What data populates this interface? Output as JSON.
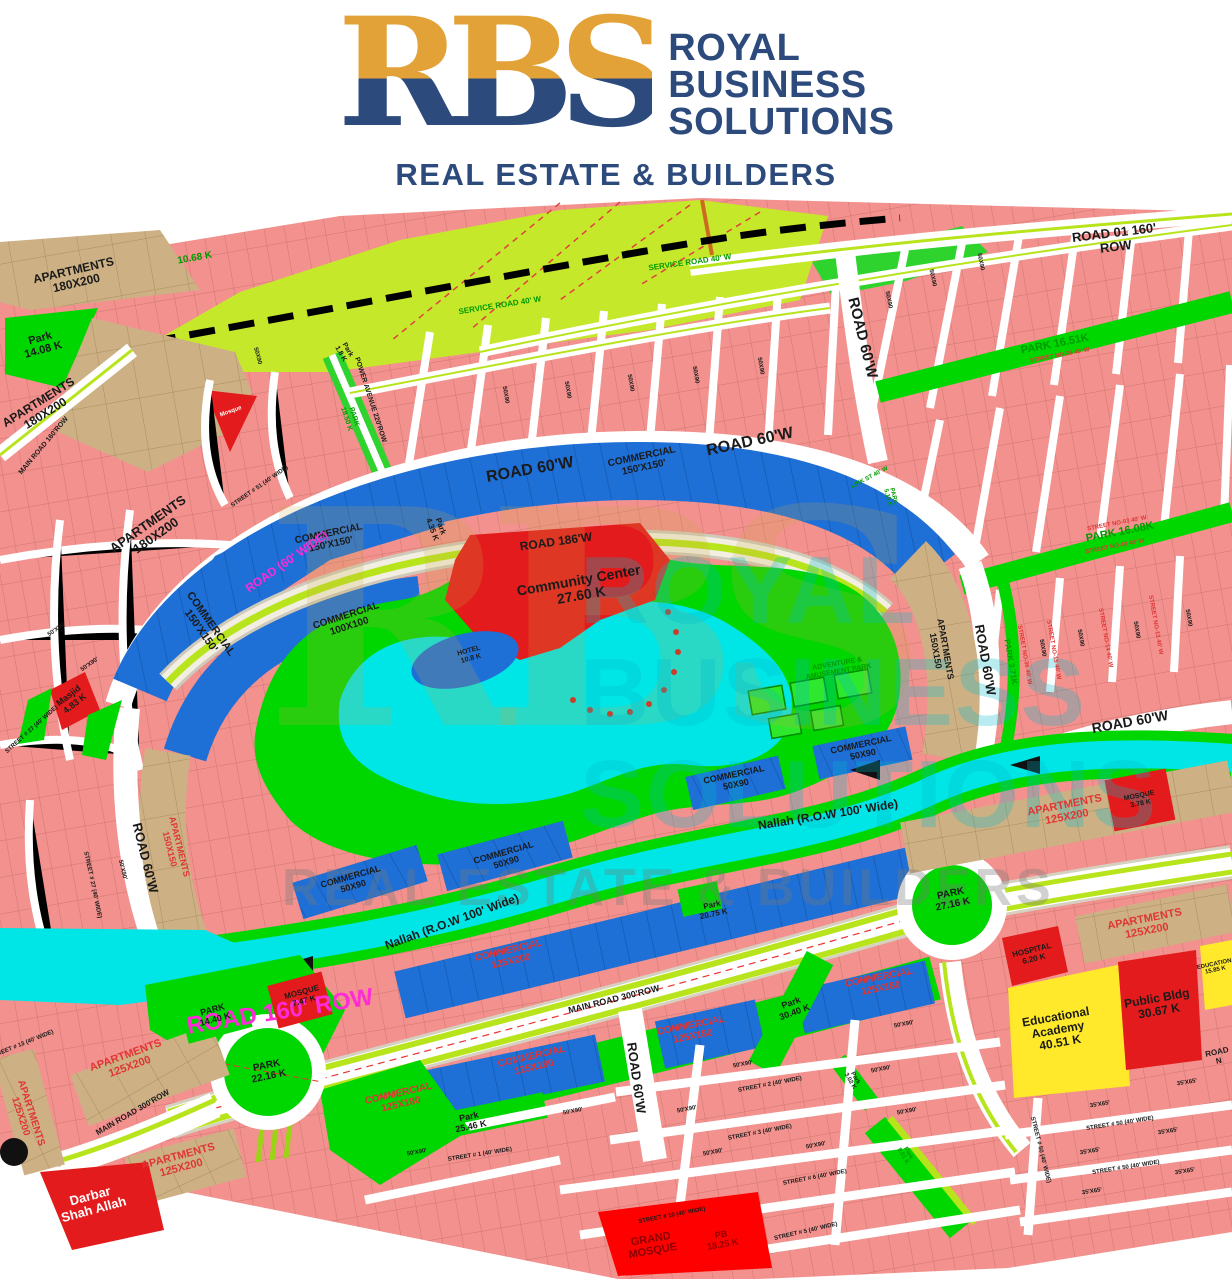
{
  "header": {
    "monogram": "RBS",
    "brand_line1": "ROYAL",
    "brand_line2": "BUSINESS",
    "brand_line3": "SOLUTIONS",
    "tagline": "REAL ESTATE & BUILDERS"
  },
  "watermark": {
    "monogram": "RBS",
    "line1": "ROYAL",
    "line2": "BUSINESS",
    "line3": "SOLUTIONS",
    "tagline": "REAL ESTATE & BUILDERS"
  },
  "palette": {
    "brand_navy": "#2c4a7c",
    "brand_gold": "#e2a237",
    "residential_pink": "#f2918d",
    "apartments_tan": "#cdb184",
    "commercial_blue": "#1e6fd6",
    "park_green": "#00d600",
    "lime_zone": "#c6e82a",
    "water_cyan": "#00e5e5",
    "civic_red": "#e31b1c",
    "education_yellow": "#ffe92a",
    "road_median": "#b8e41c",
    "label_colors": {
      "k": "#1a1a1a",
      "m": "#ff2bd6",
      "r": "#e03535",
      "g": "#009a00",
      "w": "#ffffff",
      "b": "#8b0000"
    }
  },
  "map": {
    "labels": [
      {
        "t": "ROAD 01 160' ROW",
        "x": 1115,
        "y": 240,
        "r": -7,
        "s": 13,
        "c": "k",
        "w": 700
      },
      {
        "t": "SERVICE ROAD 40' W",
        "x": 690,
        "y": 263,
        "r": -8,
        "s": 8,
        "c": "g"
      },
      {
        "t": "SERVICE ROAD 40' W",
        "x": 500,
        "y": 306,
        "r": -9,
        "s": 8,
        "c": "g"
      },
      {
        "t": "10.68 K",
        "x": 195,
        "y": 259,
        "r": -10,
        "s": 10,
        "c": "g",
        "w": 700
      },
      {
        "t": "APARTMENTS\n180X200",
        "x": 75,
        "y": 277,
        "r": -13,
        "s": 12,
        "c": "k",
        "w": 700
      },
      {
        "t": "Park\n14.08 K",
        "x": 42,
        "y": 345,
        "r": -15,
        "s": 11,
        "c": "k",
        "w": 700
      },
      {
        "t": "APARTMENTS\n180X200",
        "x": 42,
        "y": 408,
        "r": -32,
        "s": 12,
        "c": "k",
        "w": 700
      },
      {
        "t": "APARTMENTS\n180X200",
        "x": 152,
        "y": 530,
        "r": -35,
        "s": 13,
        "c": "k",
        "w": 700
      },
      {
        "t": "MAIN ROAD 160'ROW",
        "x": 44,
        "y": 446,
        "r": -50,
        "s": 7,
        "c": "k"
      },
      {
        "t": "POWER AVENUE 220'ROW",
        "x": 370,
        "y": 400,
        "r": 72,
        "s": 7,
        "c": "k"
      },
      {
        "t": "PARK\n18.50 K",
        "x": 350,
        "y": 418,
        "r": 72,
        "s": 7,
        "c": "g"
      },
      {
        "t": "Park\n1.8 K",
        "x": 344,
        "y": 352,
        "r": 60,
        "s": 7,
        "c": "k"
      },
      {
        "t": "Mosque",
        "x": 231,
        "y": 412,
        "r": -20,
        "s": 6,
        "c": "w"
      },
      {
        "t": "STREET # 51 (40' WIDE)",
        "x": 260,
        "y": 487,
        "r": -35,
        "s": 6,
        "c": "k"
      },
      {
        "t": "50X90",
        "x": 257,
        "y": 356,
        "r": 75,
        "s": 6,
        "c": "k"
      },
      {
        "t": "50X90",
        "x": 505,
        "y": 395,
        "r": 80,
        "s": 6,
        "c": "k"
      },
      {
        "t": "50X90",
        "x": 567,
        "y": 390,
        "r": 80,
        "s": 6,
        "c": "k"
      },
      {
        "t": "50X90",
        "x": 630,
        "y": 383,
        "r": 80,
        "s": 6,
        "c": "k"
      },
      {
        "t": "50X90",
        "x": 695,
        "y": 375,
        "r": 80,
        "s": 6,
        "c": "k"
      },
      {
        "t": "50X90",
        "x": 760,
        "y": 366,
        "r": 80,
        "s": 6,
        "c": "k"
      },
      {
        "t": "50X90",
        "x": 888,
        "y": 300,
        "r": 78,
        "s": 6,
        "c": "k"
      },
      {
        "t": "50X90",
        "x": 932,
        "y": 278,
        "r": 78,
        "s": 6,
        "c": "k"
      },
      {
        "t": "50X90",
        "x": 980,
        "y": 262,
        "r": 78,
        "s": 6,
        "c": "k"
      },
      {
        "t": "ROAD 60'W",
        "x": 530,
        "y": 470,
        "r": -10,
        "s": 16,
        "c": "k",
        "w": 700
      },
      {
        "t": "ROAD 60'W",
        "x": 750,
        "y": 442,
        "r": -12,
        "s": 16,
        "c": "k",
        "w": 700
      },
      {
        "t": "COMMERCIAL\n150'X150'",
        "x": 643,
        "y": 463,
        "r": -12,
        "s": 10,
        "c": "k",
        "w": 700
      },
      {
        "t": "ROAD 186'W",
        "x": 556,
        "y": 542,
        "r": -8,
        "s": 12,
        "c": "k",
        "w": 700
      },
      {
        "t": "Community Center\n27.60 K",
        "x": 580,
        "y": 588,
        "r": -10,
        "s": 14,
        "c": "k",
        "w": 700
      },
      {
        "t": "COMMERCIAL\n150'X150'",
        "x": 330,
        "y": 540,
        "r": -12,
        "s": 10,
        "c": "k",
        "w": 700
      },
      {
        "t": "ROAD (60' WIDE)",
        "x": 287,
        "y": 562,
        "r": -35,
        "s": 12,
        "c": "m",
        "w": 700
      },
      {
        "t": "COMMERCIAL\n150'X150'",
        "x": 205,
        "y": 628,
        "r": 55,
        "s": 11,
        "c": "k",
        "w": 700
      },
      {
        "t": "COMMERCIAL\n100X100",
        "x": 348,
        "y": 622,
        "r": -18,
        "s": 10,
        "c": "k",
        "w": 700
      },
      {
        "t": "Park\n4.35 K",
        "x": 436,
        "y": 528,
        "r": 70,
        "s": 8,
        "c": "k"
      },
      {
        "t": "HOTEL\n10.8 K",
        "x": 470,
        "y": 655,
        "r": -15,
        "s": 7,
        "c": "k"
      },
      {
        "t": "ADVENTURE &\nAMUSEMENT PARK",
        "x": 838,
        "y": 668,
        "r": -10,
        "s": 7,
        "c": "g",
        "w": 700
      },
      {
        "t": "COMMERCIAL\n50X90",
        "x": 862,
        "y": 750,
        "r": -12,
        "s": 9,
        "c": "k",
        "w": 700
      },
      {
        "t": "COMMERCIAL\n50X90",
        "x": 735,
        "y": 780,
        "r": -12,
        "s": 9,
        "c": "k",
        "w": 700
      },
      {
        "t": "COMMERCIAL\n50X90",
        "x": 505,
        "y": 858,
        "r": -16,
        "s": 9,
        "c": "k",
        "w": 700
      },
      {
        "t": "COMMERCIAL\n50X90",
        "x": 352,
        "y": 882,
        "r": -16,
        "s": 9,
        "c": "k",
        "w": 700
      },
      {
        "t": "APARTMENTS\n150X150",
        "x": 940,
        "y": 650,
        "r": 80,
        "s": 9,
        "c": "k",
        "w": 700
      },
      {
        "t": "ROAD 60'W",
        "x": 985,
        "y": 660,
        "r": 80,
        "s": 13,
        "c": "k",
        "w": 700
      },
      {
        "t": "PARK 3.71K",
        "x": 1010,
        "y": 662,
        "r": 80,
        "s": 8,
        "c": "g",
        "w": 700
      },
      {
        "t": "STREET NO-36 40' W",
        "x": 1024,
        "y": 655,
        "r": 80,
        "s": 6,
        "c": "r"
      },
      {
        "t": "50X90",
        "x": 1042,
        "y": 648,
        "r": 80,
        "s": 6,
        "c": "k"
      },
      {
        "t": "ROAD 60'W",
        "x": 862,
        "y": 338,
        "r": 76,
        "s": 15,
        "c": "k",
        "w": 700
      },
      {
        "t": "PARK 16.51K",
        "x": 1055,
        "y": 345,
        "r": -11,
        "s": 11,
        "c": "g",
        "w": 700
      },
      {
        "t": "STREET NO-26 40' W",
        "x": 1060,
        "y": 356,
        "r": -11,
        "s": 6,
        "c": "r"
      },
      {
        "t": "LINK ST 40' W",
        "x": 870,
        "y": 478,
        "r": -28,
        "s": 6,
        "c": "g"
      },
      {
        "t": "PARK\n5.15 K",
        "x": 890,
        "y": 497,
        "r": 75,
        "s": 6,
        "c": "g"
      },
      {
        "t": "PARK 16.08K",
        "x": 1120,
        "y": 533,
        "r": -11,
        "s": 11,
        "c": "g",
        "w": 700
      },
      {
        "t": "STREET NO-03 40' W",
        "x": 1117,
        "y": 524,
        "r": -11,
        "s": 6,
        "c": "r"
      },
      {
        "t": "STREET NO-10 40' W",
        "x": 1115,
        "y": 547,
        "r": -11,
        "s": 6,
        "c": "r"
      },
      {
        "t": "STREET NO-13 40' W",
        "x": 1155,
        "y": 625,
        "r": 80,
        "s": 6,
        "c": "r"
      },
      {
        "t": "STREET NO-14 40' W",
        "x": 1105,
        "y": 638,
        "r": 80,
        "s": 6,
        "c": "r"
      },
      {
        "t": "STREET NO-15 40' W",
        "x": 1053,
        "y": 650,
        "r": 80,
        "s": 6,
        "c": "r"
      },
      {
        "t": "50X90",
        "x": 1080,
        "y": 638,
        "r": 80,
        "s": 6,
        "c": "k"
      },
      {
        "t": "50X90",
        "x": 1136,
        "y": 630,
        "r": 80,
        "s": 6,
        "c": "k"
      },
      {
        "t": "50X90",
        "x": 1188,
        "y": 618,
        "r": 80,
        "s": 6,
        "c": "k"
      },
      {
        "t": "ROAD 60'W",
        "x": 1130,
        "y": 722,
        "r": -10,
        "s": 14,
        "c": "k",
        "w": 700
      },
      {
        "t": "Nallah (R.O.W 100' Wide)",
        "x": 828,
        "y": 815,
        "r": -9,
        "s": 12,
        "c": "k",
        "w": 700
      },
      {
        "t": "Nallah (R.O.W 100' Wide)",
        "x": 452,
        "y": 922,
        "r": -20,
        "s": 12,
        "c": "k",
        "w": 700
      },
      {
        "t": "ROAD 160' ROW",
        "x": 280,
        "y": 1012,
        "r": -9,
        "s": 24,
        "c": "m",
        "w": 700
      },
      {
        "t": "PARK\n14.40 K",
        "x": 214,
        "y": 1015,
        "r": -15,
        "s": 9,
        "c": "k",
        "w": 700
      },
      {
        "t": "MOSQUE\n7.47 K",
        "x": 303,
        "y": 997,
        "r": -15,
        "s": 8,
        "c": "k",
        "w": 700
      },
      {
        "t": "PARK\n22.16 K",
        "x": 268,
        "y": 1072,
        "r": -12,
        "s": 10,
        "c": "k",
        "w": 700
      },
      {
        "t": "PARK\n27.16 K",
        "x": 952,
        "y": 900,
        "r": -12,
        "s": 10,
        "c": "k",
        "w": 700
      },
      {
        "t": "APARTMENTS\n125X200",
        "x": 1066,
        "y": 812,
        "r": -11,
        "s": 11,
        "c": "r",
        "w": 700
      },
      {
        "t": "MOSQUE\n3.78 K",
        "x": 1140,
        "y": 800,
        "r": -11,
        "s": 7,
        "c": "k",
        "w": 700
      },
      {
        "t": "APARTMENTS\n125X200",
        "x": 1146,
        "y": 926,
        "r": -11,
        "s": 11,
        "c": "r",
        "w": 700
      },
      {
        "t": "HOSPITAL\n6.20 K",
        "x": 1033,
        "y": 955,
        "r": -14,
        "s": 8,
        "c": "k",
        "w": 700
      },
      {
        "t": "Educational\nAcademy\n40.51 K",
        "x": 1058,
        "y": 1030,
        "r": -10,
        "s": 12,
        "c": "k",
        "w": 700
      },
      {
        "t": "Public Bldg\n30.67 K",
        "x": 1158,
        "y": 1005,
        "r": -10,
        "s": 12,
        "c": "k",
        "w": 700
      },
      {
        "t": "EDUCATION\n15.85 K",
        "x": 1215,
        "y": 968,
        "r": -12,
        "s": 6,
        "c": "k",
        "w": 700
      },
      {
        "t": "ROAD N",
        "x": 1218,
        "y": 1057,
        "r": -12,
        "s": 8,
        "c": "k"
      },
      {
        "t": "APARTMENTS\n125X200",
        "x": 128,
        "y": 1062,
        "r": -20,
        "s": 11,
        "c": "r",
        "w": 700
      },
      {
        "t": "APARTMENTS\n125X200",
        "x": 25,
        "y": 1115,
        "r": 72,
        "s": 10,
        "c": "r",
        "w": 700
      },
      {
        "t": "APARTMENTS\n125X200",
        "x": 180,
        "y": 1163,
        "r": -15,
        "s": 11,
        "c": "r",
        "w": 700
      },
      {
        "t": "MAIN ROAD 300'ROW",
        "x": 133,
        "y": 1113,
        "r": -30,
        "s": 8,
        "c": "k"
      },
      {
        "t": "MAIN ROAD 300'ROW",
        "x": 614,
        "y": 1000,
        "r": -14,
        "s": 9,
        "c": "k"
      },
      {
        "t": "Darbar\nShah Allah",
        "x": 92,
        "y": 1203,
        "r": -15,
        "s": 13,
        "c": "w",
        "w": 700
      },
      {
        "t": "COMMERCIAL\n125X200",
        "x": 510,
        "y": 957,
        "r": -13,
        "s": 10,
        "c": "r",
        "w": 700
      },
      {
        "t": "COMMERCIAL\n125X180",
        "x": 692,
        "y": 1032,
        "r": -11,
        "s": 10,
        "c": "r",
        "w": 700
      },
      {
        "t": "COMMERCIAL\n125X180",
        "x": 880,
        "y": 984,
        "r": -11,
        "s": 10,
        "c": "r",
        "w": 700
      },
      {
        "t": "COMMERCIAL\n125X180",
        "x": 533,
        "y": 1063,
        "r": -13,
        "s": 10,
        "c": "r",
        "w": 700
      },
      {
        "t": "COMMERCIAL\n125X180",
        "x": 400,
        "y": 1100,
        "r": -13,
        "s": 10,
        "c": "r",
        "w": 700
      },
      {
        "t": "ROAD 60'W",
        "x": 636,
        "y": 1078,
        "r": 82,
        "s": 13,
        "c": "k",
        "w": 700
      },
      {
        "t": "Park\n25.46 K",
        "x": 470,
        "y": 1122,
        "r": -12,
        "s": 9,
        "c": "k",
        "w": 700
      },
      {
        "t": "Park\n30.40 K",
        "x": 793,
        "y": 1008,
        "r": -20,
        "s": 9,
        "c": "k",
        "w": 700
      },
      {
        "t": "Park\n20.75 K",
        "x": 713,
        "y": 910,
        "r": -12,
        "s": 8,
        "c": "k"
      },
      {
        "t": "Park\n3.02 K",
        "x": 852,
        "y": 1080,
        "r": 60,
        "s": 6,
        "c": "k"
      },
      {
        "t": "Park\n9.01 K",
        "x": 905,
        "y": 1155,
        "r": 60,
        "s": 6,
        "c": "g"
      },
      {
        "t": "GRAND\nMOSQUE",
        "x": 652,
        "y": 1246,
        "r": -10,
        "s": 11,
        "c": "b",
        "w": 700
      },
      {
        "t": "PB\n18.25 K",
        "x": 722,
        "y": 1240,
        "r": -10,
        "s": 9,
        "c": "b",
        "w": 700
      },
      {
        "t": "STREET # 10 (40' WIDE)",
        "x": 672,
        "y": 1216,
        "r": -11,
        "s": 6,
        "c": "k"
      },
      {
        "t": "STREET # 6 (40' WIDE)",
        "x": 815,
        "y": 1178,
        "r": -11,
        "s": 6,
        "c": "k"
      },
      {
        "t": "STREET # 5 (40' WIDE)",
        "x": 806,
        "y": 1232,
        "r": -13,
        "s": 6,
        "c": "k"
      },
      {
        "t": "STREET # 2 (40' WIDE)",
        "x": 770,
        "y": 1085,
        "r": -11,
        "s": 6,
        "c": "k"
      },
      {
        "t": "STREET # 3 (40' WIDE)",
        "x": 760,
        "y": 1133,
        "r": -11,
        "s": 6,
        "c": "k"
      },
      {
        "t": "STREET # 1 (40' WIDE)",
        "x": 480,
        "y": 1155,
        "r": -9,
        "s": 6,
        "c": "k"
      },
      {
        "t": "STREET # 50 (40' WIDE)",
        "x": 1120,
        "y": 1124,
        "r": -9,
        "s": 6,
        "c": "k"
      },
      {
        "t": "STREET # 50 (40' WIDE)",
        "x": 1126,
        "y": 1168,
        "r": -9,
        "s": 6,
        "c": "k"
      },
      {
        "t": "STREET # 50 (40' WIDE)",
        "x": 1040,
        "y": 1150,
        "r": 76,
        "s": 6,
        "c": "k"
      },
      {
        "t": "35'X65'",
        "x": 1100,
        "y": 1105,
        "r": -9,
        "s": 6,
        "c": "k"
      },
      {
        "t": "35'X65'",
        "x": 1187,
        "y": 1083,
        "r": -9,
        "s": 6,
        "c": "k"
      },
      {
        "t": "35'X65'",
        "x": 1168,
        "y": 1132,
        "r": -9,
        "s": 6,
        "c": "k"
      },
      {
        "t": "35'X65'",
        "x": 1090,
        "y": 1152,
        "r": -9,
        "s": 6,
        "c": "k"
      },
      {
        "t": "35'X65'",
        "x": 1185,
        "y": 1172,
        "r": -9,
        "s": 6,
        "c": "k"
      },
      {
        "t": "35'X65'",
        "x": 1092,
        "y": 1192,
        "r": -9,
        "s": 6,
        "c": "k"
      },
      {
        "t": "50'X90'",
        "x": 573,
        "y": 1112,
        "r": -11,
        "s": 6,
        "c": "k"
      },
      {
        "t": "50'X90'",
        "x": 687,
        "y": 1110,
        "r": -11,
        "s": 6,
        "c": "k"
      },
      {
        "t": "50'X90'",
        "x": 417,
        "y": 1153,
        "r": -11,
        "s": 6,
        "c": "k"
      },
      {
        "t": "50'X90'",
        "x": 713,
        "y": 1153,
        "r": -11,
        "s": 6,
        "c": "k"
      },
      {
        "t": "50'X90'",
        "x": 904,
        "y": 1025,
        "r": -11,
        "s": 6,
        "c": "k"
      },
      {
        "t": "50'X90'",
        "x": 743,
        "y": 1065,
        "r": -11,
        "s": 6,
        "c": "k"
      },
      {
        "t": "50'X90'",
        "x": 881,
        "y": 1070,
        "r": -11,
        "s": 6,
        "c": "k"
      },
      {
        "t": "50'X90'",
        "x": 907,
        "y": 1112,
        "r": -11,
        "s": 6,
        "c": "k"
      },
      {
        "t": "50'X90'",
        "x": 816,
        "y": 1146,
        "r": -11,
        "s": 6,
        "c": "k"
      },
      {
        "t": "STREET # 13 (40' WIDE)",
        "x": 22,
        "y": 1045,
        "r": -22,
        "s": 6,
        "c": "k"
      },
      {
        "t": "STREET # 27 (40' WIDE)",
        "x": 32,
        "y": 730,
        "r": -42,
        "s": 6,
        "c": "k"
      },
      {
        "t": "STREET # 27 (40' WIDE)",
        "x": 92,
        "y": 885,
        "r": 78,
        "s": 6,
        "c": "k"
      },
      {
        "t": "Masjid\n4.83 K",
        "x": 72,
        "y": 700,
        "r": -38,
        "s": 9,
        "c": "k",
        "w": 700
      },
      {
        "t": "ROAD 60'W",
        "x": 145,
        "y": 858,
        "r": 76,
        "s": 13,
        "c": "k",
        "w": 700
      },
      {
        "t": "APARTMENTS\n150X150",
        "x": 174,
        "y": 848,
        "r": 76,
        "s": 9,
        "c": "r",
        "w": 700
      },
      {
        "t": "50'X90'",
        "x": 57,
        "y": 630,
        "r": -35,
        "s": 6,
        "c": "k"
      },
      {
        "t": "50'X90'",
        "x": 90,
        "y": 665,
        "r": -35,
        "s": 6,
        "c": "k"
      },
      {
        "t": "50'X90'",
        "x": 122,
        "y": 870,
        "r": 76,
        "s": 6,
        "c": "k"
      }
    ]
  }
}
